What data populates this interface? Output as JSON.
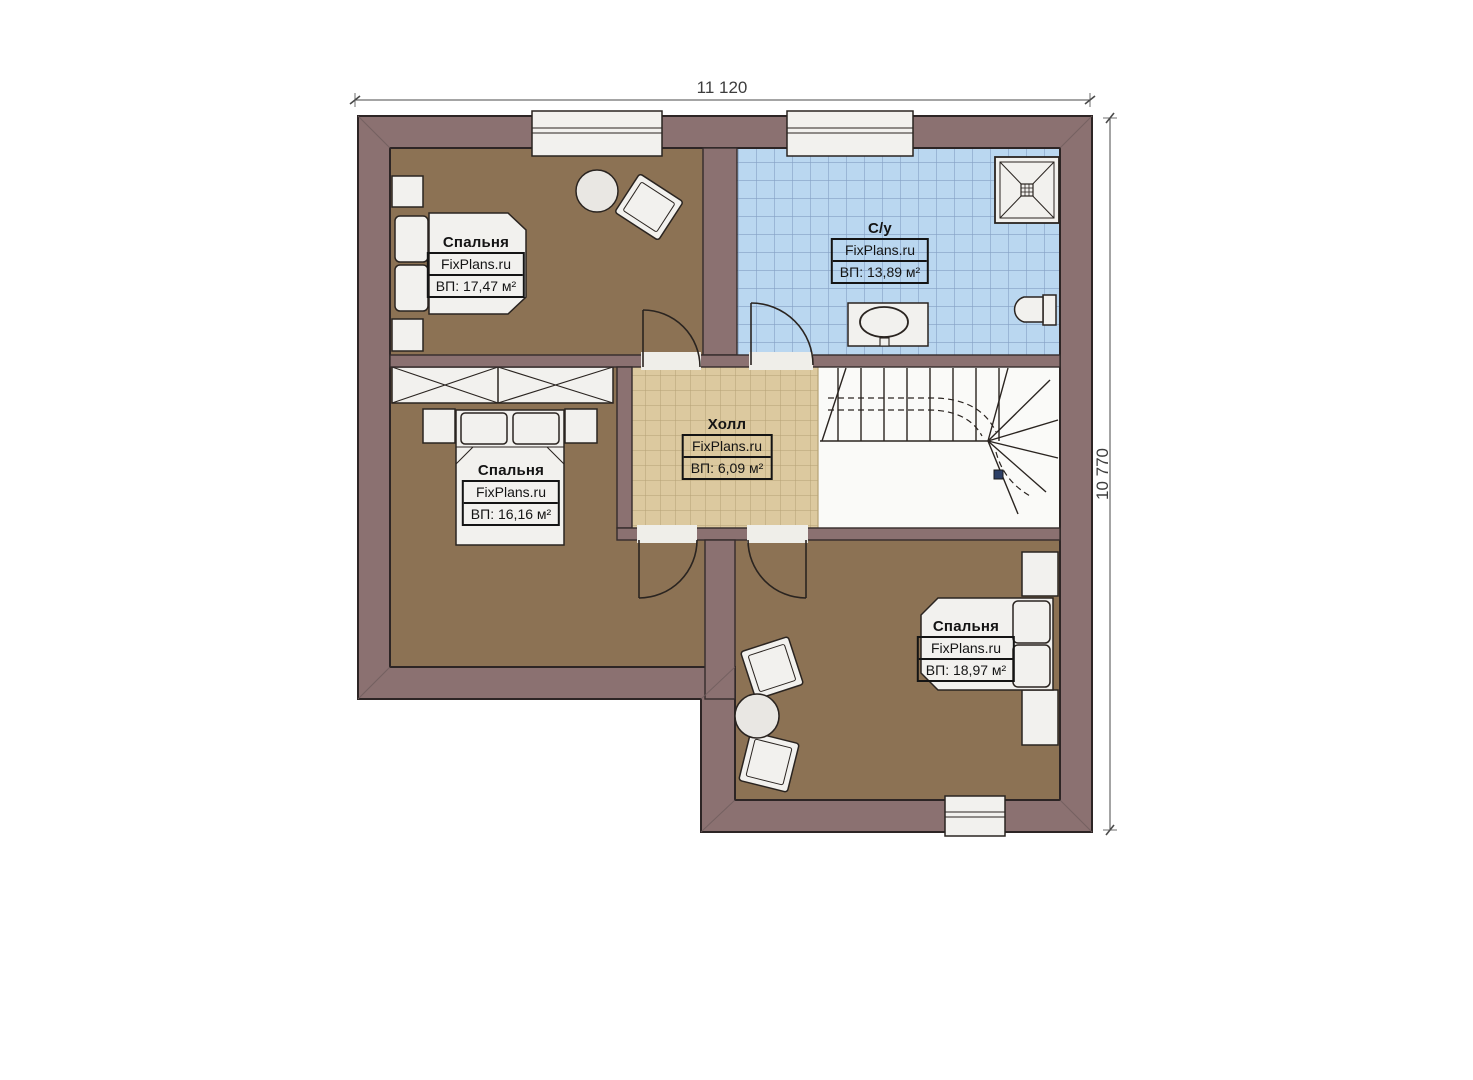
{
  "plan": {
    "type": "floor-plan",
    "dimensions": {
      "top": "11 120",
      "right": "10 770"
    },
    "rooms": [
      {
        "name": "Спальня",
        "brand": "FixPlans.ru",
        "area": "ВП: 17,47 м²"
      },
      {
        "name": "С/у",
        "brand": "FixPlans.ru",
        "area": "ВП: 13,89 м²"
      },
      {
        "name": "Холл",
        "brand": "FixPlans.ru",
        "area": "ВП: 6,09 м²"
      },
      {
        "name": "Спальня",
        "brand": "FixPlans.ru",
        "area": "ВП: 16,16 м²"
      },
      {
        "name": "Спальня",
        "brand": "FixPlans.ru",
        "area": "ВП: 18,97 м²"
      }
    ],
    "colors": {
      "wall": "#8b7171",
      "outline": "#2d2525",
      "bedroom_floor": "#8c7254",
      "bath_tile": "#bad7f0",
      "bath_grid": "#84a0c4",
      "hall_tile": "#dcc99f",
      "hall_grid": "#b5a174",
      "fixture": "#f2f1ee"
    }
  }
}
